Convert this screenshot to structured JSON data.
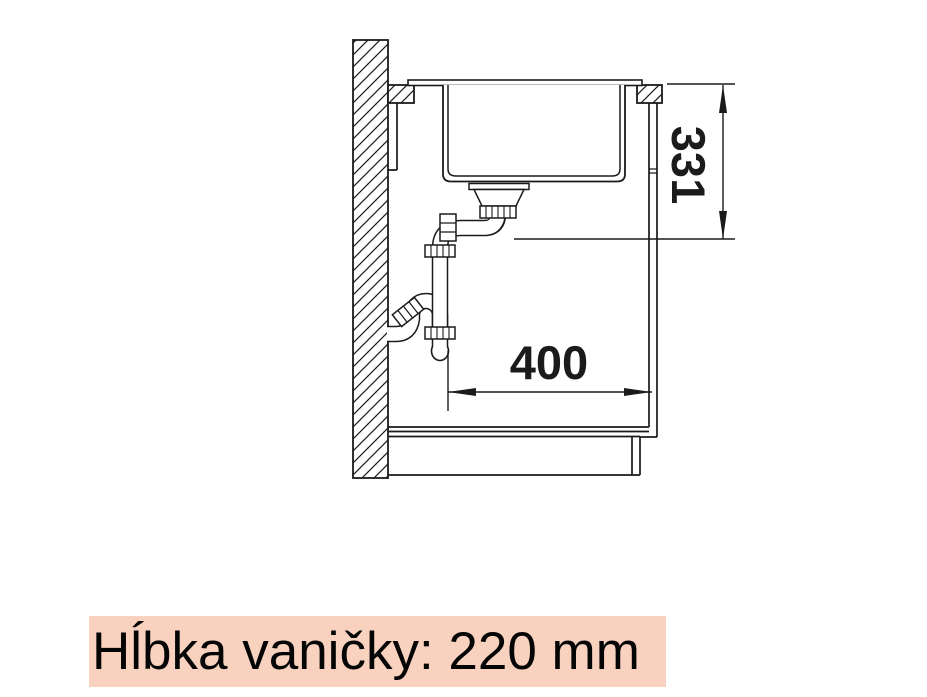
{
  "diagram": {
    "type": "technical-drawing",
    "subject": "kitchen sink side-section installation drawing with drain siphon",
    "dimensions": {
      "vertical_label": "331",
      "horizontal_label": "400"
    },
    "caption": {
      "text": "Hĺbka vaničky: 220 mm",
      "highlight_color": "#f8d2bf",
      "text_color": "#050505"
    },
    "line_color": "#1b1b1b",
    "background_color": "#ffffff"
  }
}
